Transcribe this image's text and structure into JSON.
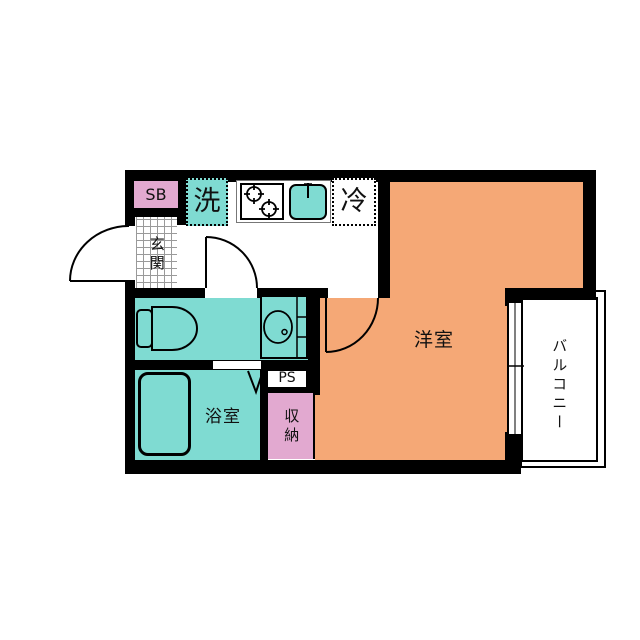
{
  "labels": {
    "shoe_box": "SB",
    "washer": "洗",
    "refrigerator": "冷",
    "entrance": "玄関",
    "western_room": "洋室",
    "bathroom": "浴室",
    "storage": "収納",
    "pipe_space": "PS",
    "balcony": "バルコニー"
  },
  "colors": {
    "teal": "#7FDBD2",
    "orange": "#F5A876",
    "pink": "#E2A9D0",
    "wall": "#000000",
    "grid-line": "#9a9a9a",
    "counter-border": "#777777"
  },
  "icons": {
    "stove": "two-burner-stove-icon",
    "sink": "kitchen-sink-icon",
    "toilet": "toilet-icon",
    "washbasin": "washbasin-icon",
    "bathtub": "bathtub-icon",
    "doors": "door-swing-arc-icon",
    "folding_door": "folding-door-v-icon",
    "window": "sliding-window-icon"
  }
}
